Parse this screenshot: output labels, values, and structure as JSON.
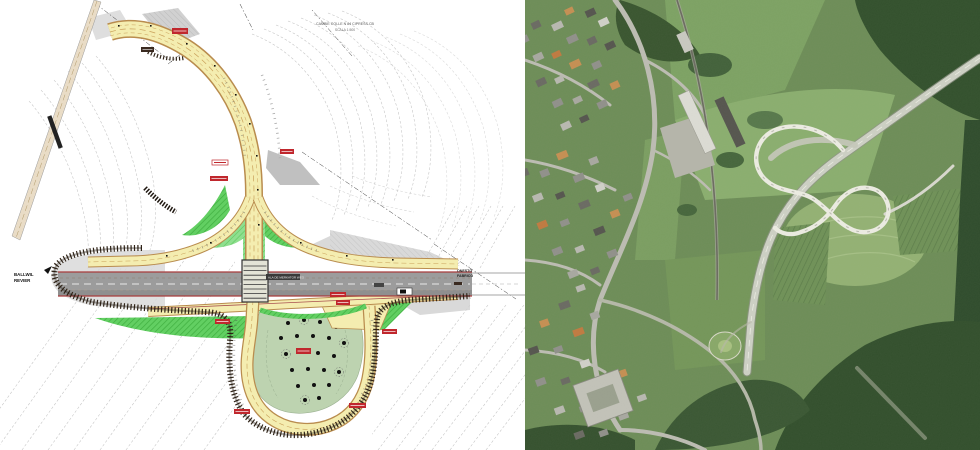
{
  "page": {
    "background": "#ffffff",
    "left_panel": "engineering-plan",
    "right_panel": "aerial-photo"
  },
  "plan": {
    "title": {
      "line1": "CAMBIE COLLE N 84 CIPRESS CB",
      "line2": "SCALA 1:500"
    },
    "west_label": {
      "line1": "BALLWIL",
      "line2": "REVIER"
    },
    "east_label": {
      "line1": "ONESTO",
      "line2": "FABRICO"
    },
    "road_badge": "ALA DE MERKATOR WEG",
    "colors": {
      "road_fill": "#f4edb0",
      "road_edge": "#b98c4e",
      "green_area": "#62cf62",
      "loop_interior": "#bdd3b0",
      "highway": "#9c9c9c",
      "edge_line_red": "#a83c3c",
      "annotation_red": "#c0272d",
      "embankment": "#32261a",
      "contour_gray": "#c2c2c2",
      "railway_beige": "#e9dcc6"
    }
  },
  "aerial": {
    "colors": {
      "field_green": "#6d8d57",
      "forest_green": "#39552f",
      "ramp_white": "#ecece2",
      "roof_gray": "#90908a",
      "roof_orange": "#c58f52"
    },
    "features": {
      "interchange": "figure-eight-loop-ramp",
      "village": "village-west-side",
      "railway": "railway-line",
      "warehouse": "long-warehouse-building",
      "forest": "forest-patches"
    }
  }
}
